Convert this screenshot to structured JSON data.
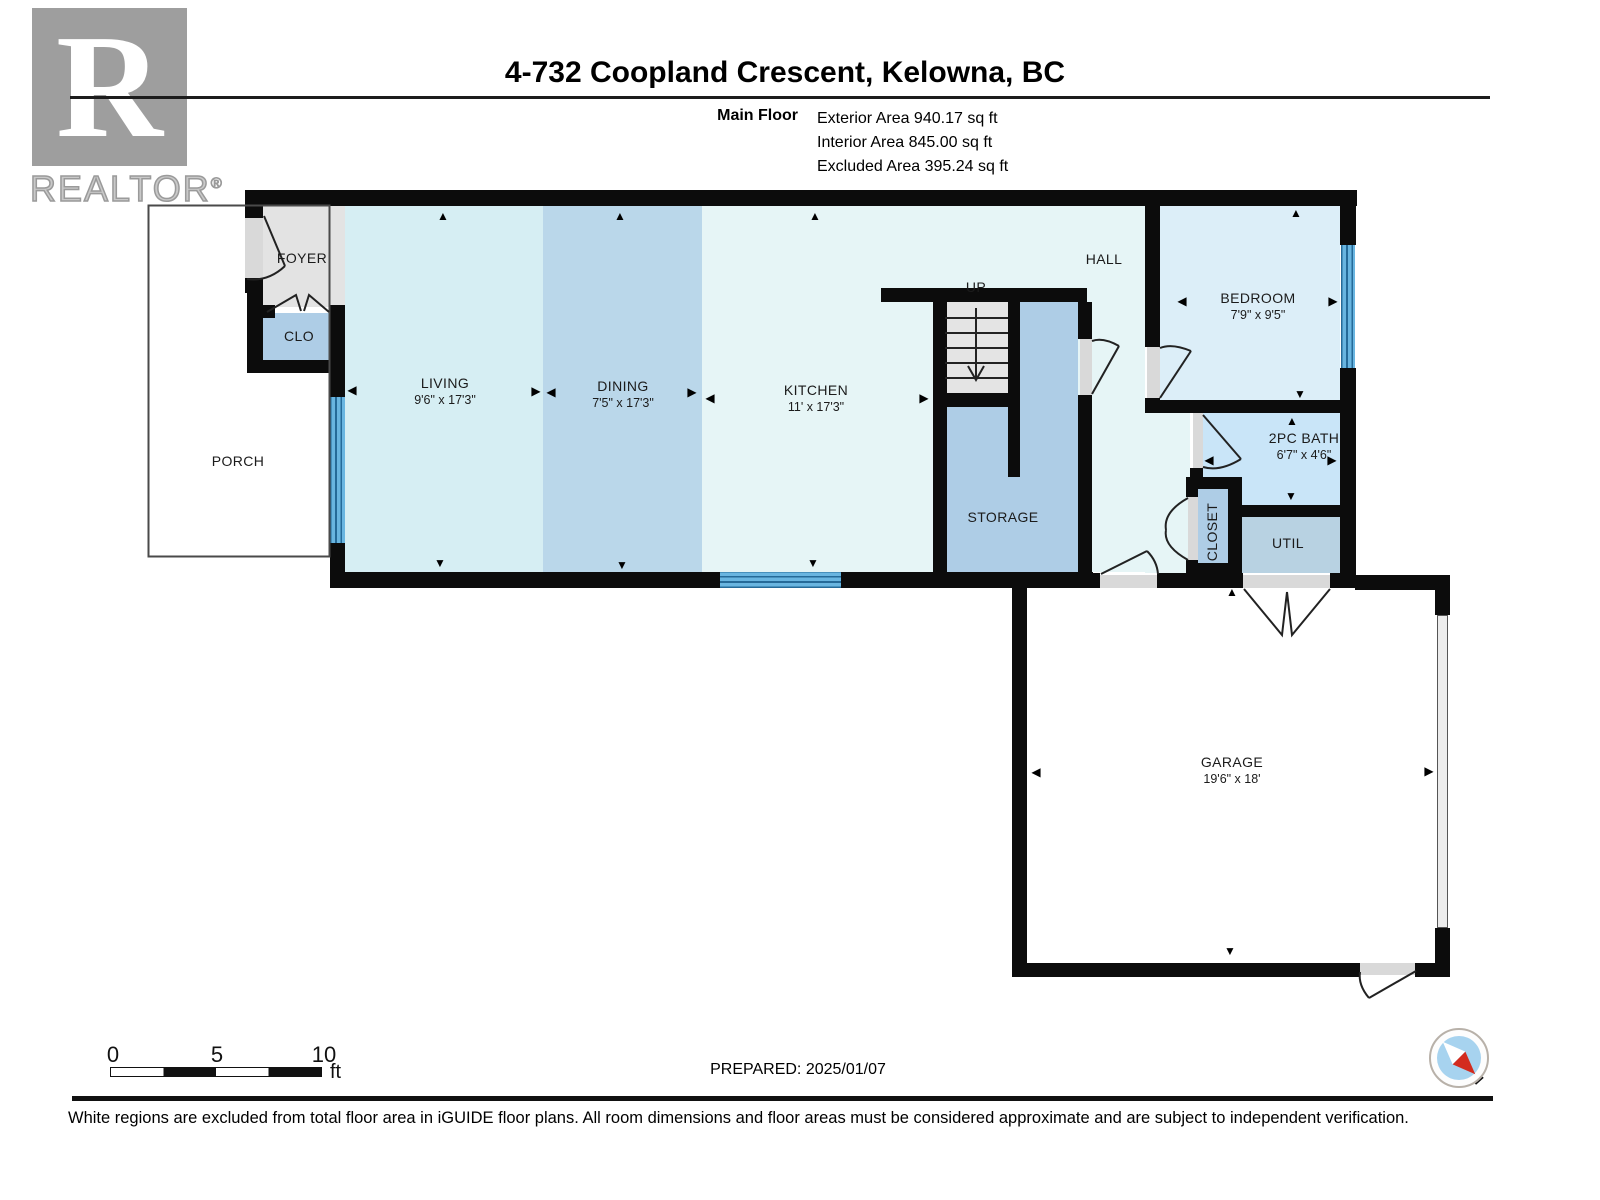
{
  "header": {
    "logo": {
      "letter": "R",
      "brand": "REALTOR",
      "registered": "®"
    },
    "title": "4-732 Coopland Crescent, Kelowna, BC",
    "floor_label": "Main Floor",
    "areas": [
      "Exterior Area 940.17 sq ft",
      "Interior Area 845.00 sq ft",
      "Excluded Area 395.24 sq ft"
    ]
  },
  "plan": {
    "rooms": [
      {
        "id": "foyer",
        "label": "FOYER",
        "dims": "",
        "x": 302,
        "y": 258
      },
      {
        "id": "clo",
        "label": "CLO",
        "dims": "",
        "x": 299,
        "y": 336
      },
      {
        "id": "porch",
        "label": "PORCH",
        "dims": "",
        "x": 238,
        "y": 461
      },
      {
        "id": "living",
        "label": "LIVING",
        "dims": "9'6\" x 17'3\"",
        "x": 445,
        "y": 391
      },
      {
        "id": "dining",
        "label": "DINING",
        "dims": "7'5\" x 17'3\"",
        "x": 623,
        "y": 394
      },
      {
        "id": "kitchen",
        "label": "KITCHEN",
        "dims": "11' x 17'3\"",
        "x": 816,
        "y": 398
      },
      {
        "id": "stairs-up",
        "label": "UP",
        "dims": "",
        "x": 976,
        "y": 287
      },
      {
        "id": "hall",
        "label": "HALL",
        "dims": "",
        "x": 1104,
        "y": 259
      },
      {
        "id": "storage",
        "label": "STORAGE",
        "dims": "",
        "x": 1003,
        "y": 517
      },
      {
        "id": "bedroom",
        "label": "BEDROOM",
        "dims": "7'9\" x 9'5\"",
        "x": 1258,
        "y": 306
      },
      {
        "id": "bath",
        "label": "2PC BATH",
        "dims": "6'7\" x 4'6\"",
        "x": 1304,
        "y": 446
      },
      {
        "id": "closet",
        "label": "CLOSET",
        "dims": "",
        "x": 1212,
        "y": 532,
        "rotate": -90
      },
      {
        "id": "util",
        "label": "UTIL",
        "dims": "",
        "x": 1288,
        "y": 543
      },
      {
        "id": "garage",
        "label": "GARAGE",
        "dims": "19'6\" x 18'",
        "x": 1232,
        "y": 770
      }
    ],
    "arrow_glyphs": {
      "up": "▲",
      "down": "▼",
      "left": "◀",
      "right": "▶"
    },
    "arrows": [
      {
        "dir": "up",
        "x": 443,
        "y": 216
      },
      {
        "dir": "up",
        "x": 620,
        "y": 216
      },
      {
        "dir": "up",
        "x": 815,
        "y": 216
      },
      {
        "dir": "up",
        "x": 1296,
        "y": 213
      },
      {
        "dir": "up",
        "x": 1292,
        "y": 421
      },
      {
        "dir": "up",
        "x": 1232,
        "y": 592
      },
      {
        "dir": "down",
        "x": 440,
        "y": 563
      },
      {
        "dir": "down",
        "x": 622,
        "y": 565
      },
      {
        "dir": "down",
        "x": 813,
        "y": 563
      },
      {
        "dir": "down",
        "x": 1300,
        "y": 394
      },
      {
        "dir": "down",
        "x": 1291,
        "y": 496
      },
      {
        "dir": "down",
        "x": 1230,
        "y": 951
      },
      {
        "dir": "left",
        "x": 352,
        "y": 390
      },
      {
        "dir": "left",
        "x": 551,
        "y": 392
      },
      {
        "dir": "left",
        "x": 710,
        "y": 398
      },
      {
        "dir": "left",
        "x": 1182,
        "y": 301
      },
      {
        "dir": "left",
        "x": 1209,
        "y": 460
      },
      {
        "dir": "left",
        "x": 1036,
        "y": 772
      },
      {
        "dir": "right",
        "x": 536,
        "y": 391
      },
      {
        "dir": "right",
        "x": 692,
        "y": 392
      },
      {
        "dir": "right",
        "x": 924,
        "y": 398
      },
      {
        "dir": "right",
        "x": 1333,
        "y": 301
      },
      {
        "dir": "right",
        "x": 1332,
        "y": 460
      },
      {
        "dir": "right",
        "x": 1429,
        "y": 771
      }
    ]
  },
  "footer": {
    "scale": {
      "ticks": [
        "0",
        "5",
        "10"
      ],
      "unit": "ft"
    },
    "prepared": "PREPARED: 2025/01/07",
    "compass_label": "N",
    "disclaimer": "White regions are excluded from total floor area in iGUIDE floor plans. All room dimensions and floor areas must be considered approximate and are subject to independent verification."
  },
  "colors": {
    "wall": "#0c0c0c",
    "foyer_fill": "#e3e3e3",
    "stairs_fill": "#e4e4e4",
    "living_fill": "#d6eef3",
    "dining_fill": "#bad7ea",
    "kitchen_hall_fill": "#e6f5f6",
    "bedroom_fill": "#dceef8",
    "bath_fill": "#c9e5f8",
    "storage_fill": "#aecde6",
    "util_fill": "#b8d2e2",
    "window_blue": "#69b5e0",
    "threshold": "#d9d9d9",
    "compass_red": "#d32b1e",
    "compass_blue": "#a7d3ef"
  }
}
